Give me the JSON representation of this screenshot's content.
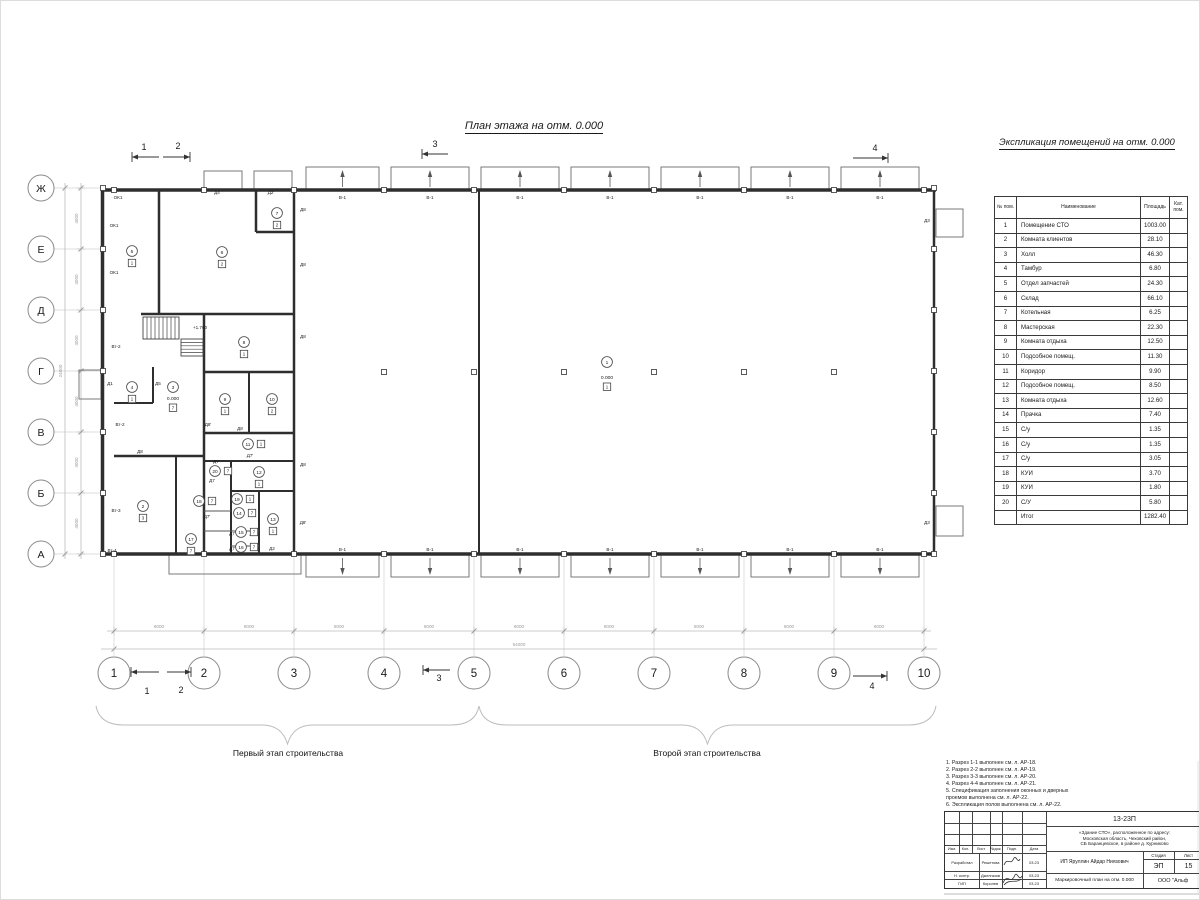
{
  "title": "План этажа на отм. 0.000",
  "explication": {
    "title": "Экспликация помещений на отм. 0.000",
    "columns": [
      "№ пом.",
      "Наименование",
      "Площадь",
      "Кат.\nпом."
    ],
    "rows": [
      [
        "1",
        "Помещение СТО",
        "1003.00"
      ],
      [
        "2",
        "Комната клиентов",
        "28.10"
      ],
      [
        "3",
        "Холл",
        "46.30"
      ],
      [
        "4",
        "Тамбур",
        "6.80"
      ],
      [
        "5",
        "Отдел запчастей",
        "24.30"
      ],
      [
        "6",
        "Склад",
        "66.10"
      ],
      [
        "7",
        "Котельная",
        "6.25"
      ],
      [
        "8",
        "Мастерская",
        "22.30"
      ],
      [
        "9",
        "Комната отдыха",
        "12.50"
      ],
      [
        "10",
        "Подсобное помещ.",
        "11.30"
      ],
      [
        "11",
        "Коридор",
        "9.90"
      ],
      [
        "12",
        "Подсобное помещ.",
        "8.50"
      ],
      [
        "13",
        "Комната отдыха",
        "12.60"
      ],
      [
        "14",
        "Прачка",
        "7.40"
      ],
      [
        "15",
        "С/у",
        "1.35"
      ],
      [
        "16",
        "С/у",
        "1.35"
      ],
      [
        "17",
        "С/у",
        "3.05"
      ],
      [
        "18",
        "КУИ",
        "3.70"
      ],
      [
        "19",
        "КУИ",
        "1.80"
      ],
      [
        "20",
        "С/У",
        "5.80"
      ]
    ],
    "total_label": "Итог",
    "total_value": "1282.40"
  },
  "plan": {
    "stage1_label": "Первый этап строительства",
    "stage2_label": "Второй этап строительства",
    "window_label": "В-1",
    "grid": {
      "cols": [
        113,
        203,
        293,
        383,
        473,
        563,
        653,
        743,
        833,
        923
      ],
      "rows": [
        187,
        248,
        309,
        370,
        431,
        492,
        553
      ],
      "letters": [
        "Ж",
        "Е",
        "Д",
        "Г",
        "В",
        "Б",
        "А"
      ],
      "numbers": [
        "1",
        "2",
        "3",
        "4",
        "5",
        "6",
        "7",
        "8",
        "9",
        "10"
      ]
    },
    "dims": {
      "seg_h": "6000",
      "total_h": "54000",
      "seg_v": "4000",
      "total_v": "24000"
    },
    "walls": [
      [
        100,
        189,
        935,
        189,
        3.5
      ],
      [
        100,
        553,
        935,
        553,
        3.5
      ],
      [
        101.5,
        189,
        101.5,
        553,
        3.5
      ],
      [
        933,
        189,
        933,
        553,
        2.5
      ],
      [
        478,
        189,
        478,
        553,
        2
      ],
      [
        293,
        189,
        293,
        553,
        2.5
      ],
      [
        158,
        189,
        158,
        313,
        2.5
      ],
      [
        140,
        313,
        293,
        313,
        2.5
      ],
      [
        255,
        189,
        255,
        231,
        2.5
      ],
      [
        255,
        231,
        293,
        231,
        2.5
      ],
      [
        203,
        313,
        203,
        553,
        2.5
      ],
      [
        203,
        371,
        293,
        371,
        2.5
      ],
      [
        248,
        371,
        248,
        432,
        2
      ],
      [
        203,
        432,
        293,
        432,
        2.5
      ],
      [
        113,
        455,
        203,
        455,
        2.5
      ],
      [
        175,
        455,
        175,
        553,
        2
      ],
      [
        203,
        460,
        293,
        460,
        2
      ],
      [
        230,
        460,
        230,
        553,
        2
      ],
      [
        230,
        490,
        293,
        490,
        2
      ],
      [
        258,
        490,
        258,
        553,
        2
      ],
      [
        152,
        366,
        152,
        402,
        2
      ],
      [
        113,
        402,
        152,
        402,
        2
      ]
    ],
    "thin": [
      [
        203,
        510,
        230,
        510
      ],
      [
        203,
        530,
        258,
        530
      ],
      [
        230,
        545,
        258,
        545
      ]
    ],
    "bays": [
      [
        305,
        378
      ],
      [
        390,
        468
      ],
      [
        480,
        558
      ],
      [
        570,
        648
      ],
      [
        660,
        738
      ],
      [
        750,
        828
      ],
      [
        840,
        918
      ]
    ],
    "bays_small_top": [
      [
        203,
        241
      ],
      [
        253,
        291
      ]
    ],
    "porches": [
      [
        78,
        369,
        22,
        29
      ],
      [
        935,
        208,
        27,
        28
      ],
      [
        935,
        505,
        27,
        30
      ],
      [
        168,
        553,
        132,
        20
      ]
    ],
    "int_cols": [
      383,
      473,
      563,
      653,
      743,
      833
    ],
    "stairs": {
      "f1": [
        142,
        316,
        36,
        22,
        9
      ],
      "f2": [
        180,
        338,
        22,
        17,
        5
      ]
    },
    "labels": [
      {
        "t": "ОК1",
        "x": 117,
        "y": 198
      },
      {
        "t": "ОК1",
        "x": 113,
        "y": 226
      },
      {
        "t": "ОК1",
        "x": 113,
        "y": 273
      },
      {
        "t": "Вт-2",
        "x": 115,
        "y": 347
      },
      {
        "t": "Вт-2",
        "x": 119,
        "y": 425
      },
      {
        "t": "Вт-3",
        "x": 115,
        "y": 511
      },
      {
        "t": "Вт-4",
        "x": 111,
        "y": 551
      },
      {
        "t": "Д1",
        "x": 109,
        "y": 384
      },
      {
        "t": "Д5",
        "x": 157,
        "y": 384
      },
      {
        "t": "Д4",
        "x": 216,
        "y": 193
      },
      {
        "t": "Д2'",
        "x": 270,
        "y": 193
      },
      {
        "t": "Д8",
        "x": 302,
        "y": 210
      },
      {
        "t": "Д8",
        "x": 302,
        "y": 265
      },
      {
        "t": "Д8",
        "x": 302,
        "y": 337
      },
      {
        "t": "Д8",
        "x": 302,
        "y": 465
      },
      {
        "t": "Д8'",
        "x": 302,
        "y": 523
      },
      {
        "t": "Д8",
        "x": 139,
        "y": 452
      },
      {
        "t": "Д8'",
        "x": 207,
        "y": 425
      },
      {
        "t": "Д8",
        "x": 239,
        "y": 429
      },
      {
        "t": "Д7",
        "x": 215,
        "y": 462
      },
      {
        "t": "Д7'",
        "x": 249,
        "y": 456
      },
      {
        "t": "Д7",
        "x": 211,
        "y": 481
      },
      {
        "t": "Д7'",
        "x": 206,
        "y": 517
      },
      {
        "t": "Д7",
        "x": 231,
        "y": 534
      },
      {
        "t": "Д7'",
        "x": 252,
        "y": 534
      },
      {
        "t": "Д7",
        "x": 231,
        "y": 549
      },
      {
        "t": "Д3",
        "x": 926,
        "y": 221
      },
      {
        "t": "Д3",
        "x": 926,
        "y": 523
      },
      {
        "t": "Д2",
        "x": 271,
        "y": 549
      },
      {
        "t": "+1.760",
        "x": 199,
        "y": 328
      }
    ],
    "bubbles": [
      {
        "n": "1",
        "x": 606,
        "y": 361
      },
      {
        "n": "2",
        "x": 142,
        "y": 505,
        "d": "3"
      },
      {
        "n": "3",
        "x": 172,
        "y": 386
      },
      {
        "n": "4",
        "x": 131,
        "y": 386,
        "d": "1"
      },
      {
        "n": "5",
        "x": 131,
        "y": 250,
        "d": "1"
      },
      {
        "n": "6",
        "x": 221,
        "y": 251,
        "d": "2"
      },
      {
        "n": "7",
        "x": 276,
        "y": 212,
        "d": "2"
      },
      {
        "n": "8",
        "x": 243,
        "y": 341,
        "d": "1"
      },
      {
        "n": "9",
        "x": 224,
        "y": 398,
        "d": "1"
      },
      {
        "n": "10",
        "x": 271,
        "y": 398,
        "d": "2"
      },
      {
        "n": "11",
        "x": 247,
        "y": 443,
        "d": "1",
        "p": "r"
      },
      {
        "n": "12",
        "x": 258,
        "y": 471,
        "d": "1"
      },
      {
        "n": "13",
        "x": 272,
        "y": 518,
        "d": "1"
      },
      {
        "n": "14",
        "x": 238,
        "y": 512,
        "d": "7",
        "p": "r"
      },
      {
        "n": "15",
        "x": 240,
        "y": 531,
        "d": "7",
        "p": "r"
      },
      {
        "n": "16",
        "x": 240,
        "y": 546,
        "d": "7",
        "p": "r"
      },
      {
        "n": "17",
        "x": 190,
        "y": 538,
        "d": "7"
      },
      {
        "n": "18",
        "x": 198,
        "y": 500,
        "d": "7",
        "p": "r"
      },
      {
        "n": "19",
        "x": 236,
        "y": 498,
        "d": "1",
        "p": "r"
      },
      {
        "n": "20",
        "x": 214,
        "y": 470,
        "d": "7",
        "p": "r"
      }
    ],
    "elevations": [
      {
        "t": "0.000",
        "x": 606,
        "y": 378,
        "d": "1"
      },
      {
        "t": "0.000",
        "x": 172,
        "y": 399,
        "d": "7"
      }
    ],
    "sections": [
      {
        "t": "1",
        "tx": 143,
        "ty": 149,
        "x1": 158,
        "y1": 156,
        "x2": 131,
        "y2": 156
      },
      {
        "t": "2",
        "tx": 177,
        "ty": 148,
        "x1": 162,
        "y1": 156,
        "x2": 189,
        "y2": 156
      },
      {
        "t": "3",
        "tx": 434,
        "ty": 146,
        "x1": 447,
        "y1": 153,
        "x2": 421,
        "y2": 153
      },
      {
        "t": "4",
        "tx": 874,
        "ty": 150,
        "x1": 852,
        "y1": 157,
        "x2": 887,
        "y2": 157
      },
      {
        "t": "1",
        "tx": 146,
        "ty": 693,
        "x1": 158,
        "y1": 671,
        "x2": 130,
        "y2": 671
      },
      {
        "t": "2",
        "tx": 180,
        "ty": 692,
        "x1": 166,
        "y1": 671,
        "x2": 190,
        "y2": 671
      },
      {
        "t": "3",
        "tx": 438,
        "ty": 680,
        "x1": 449,
        "y1": 669,
        "x2": 422,
        "y2": 669
      },
      {
        "t": "4",
        "tx": 871,
        "ty": 688,
        "x1": 852,
        "y1": 675,
        "x2": 886,
        "y2": 675
      }
    ],
    "braces": [
      [
        95,
        478
      ],
      [
        478,
        935
      ]
    ]
  },
  "notes": [
    "1. Разрез 1-1 выполнен см. л. АР-18.",
    "2. Разрез 2-2 выполнен см. л. АР-19.",
    "3. Разрез 3-3 выполнен см. л. АР-20.",
    "4. Разрез 4-4 выполнен см. л. АР-21.",
    "5. Спецификация заполнения оконных и дверных",
    "    проемов выполнена см. л. АР-22.",
    "6. Экспликация полов выполнена см. л. АР-22."
  ],
  "titleblock": {
    "doc_number": "13-23П",
    "project": "«Здание СТО», расположенное по адресу:\nМосковская область, Чеховский район,\nСБ Баранцевское, в районе д. Курниково",
    "client": "ИП Яруллин Айдар Ниязович",
    "sheet_title": "Маркировочный план на отм. 0.000",
    "company": "ООО \"Альф",
    "stage_label": "Стадия",
    "sheet_label": "Лист",
    "stage": "ЭП",
    "sheet": "15",
    "cols": [
      "Изм.",
      "Кол.",
      "Лист",
      "№док.",
      "Подп.",
      "Дата"
    ],
    "rows": [
      {
        "role": "Разработал",
        "name": "Решетова",
        "date": "03.23"
      },
      {
        "role": "Н. контр.",
        "name": "Джелгазов",
        "date": "03.23"
      },
      {
        "role": "ГИП",
        "name": "Королев",
        "date": "03.23"
      }
    ]
  }
}
